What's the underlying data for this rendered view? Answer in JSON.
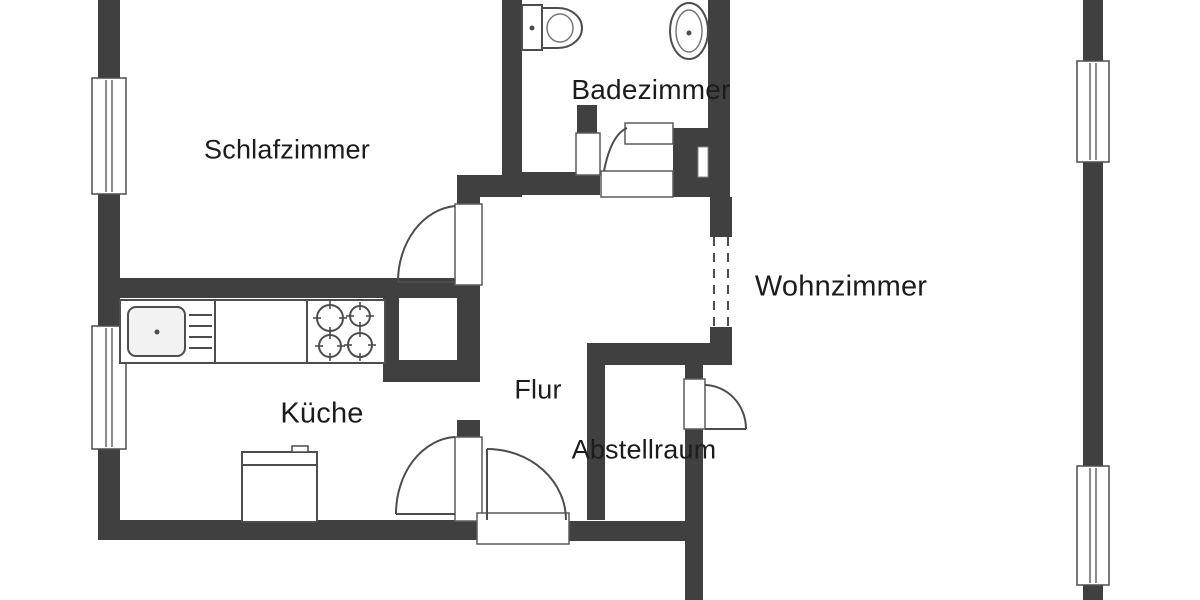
{
  "colors": {
    "wall": "#404040",
    "line": "#4d4d4d",
    "thin": "#777777",
    "label_text": "#1c1c1c",
    "background": "#ffffff",
    "sink_fill": "#f2f2f2"
  },
  "rooms": [
    {
      "id": "schlafzimmer",
      "label": "Schlafzimmer",
      "cx": 287,
      "cy": 150,
      "size": 27
    },
    {
      "id": "badezimmer",
      "label": "Badezimmer",
      "cx": 651,
      "cy": 90,
      "size": 28
    },
    {
      "id": "wohnzimmer",
      "label": "Wohnzimmer",
      "cx": 841,
      "cy": 287,
      "size": 29
    },
    {
      "id": "kueche",
      "label": "Küche",
      "cx": 322,
      "cy": 414,
      "size": 29
    },
    {
      "id": "flur",
      "label": "Flur",
      "cx": 538,
      "cy": 390,
      "size": 27
    },
    {
      "id": "abstellraum",
      "label": "Abstellraum",
      "cx": 644,
      "cy": 450,
      "size": 27
    }
  ],
  "plan": {
    "width": 1200,
    "height": 600,
    "walls": [
      {
        "n": "wall-left-top",
        "x": 98,
        "y": 0,
        "w": 22,
        "h": 80
      },
      {
        "n": "wall-left-mid",
        "x": 98,
        "y": 192,
        "w": 22,
        "h": 136
      },
      {
        "n": "wall-left-bottom",
        "x": 98,
        "y": 447,
        "w": 22,
        "h": 93
      },
      {
        "n": "wall-bottom-left",
        "x": 98,
        "y": 520,
        "w": 382,
        "h": 20
      },
      {
        "n": "wall-bottom-right",
        "x": 567,
        "y": 521,
        "w": 136,
        "h": 20
      },
      {
        "n": "wall-bedroom-bottom",
        "x": 98,
        "y": 278,
        "w": 360,
        "h": 20
      },
      {
        "n": "wall-nook-bottom",
        "x": 457,
        "y": 175,
        "w": 65,
        "h": 22
      },
      {
        "n": "wall-bedroom-bathroom",
        "x": 502,
        "y": 0,
        "w": 20,
        "h": 193
      },
      {
        "n": "wall-flur-left-stub",
        "x": 457,
        "y": 197,
        "w": 23,
        "h": 10
      },
      {
        "n": "wall-flur-left",
        "x": 457,
        "y": 283,
        "w": 23,
        "h": 99
      },
      {
        "n": "wall-niche-left",
        "x": 383,
        "y": 297,
        "w": 16,
        "h": 63
      },
      {
        "n": "wall-niche-bottom",
        "x": 383,
        "y": 360,
        "w": 97,
        "h": 22
      },
      {
        "n": "wall-kitchen-door-stub",
        "x": 457,
        "y": 420,
        "w": 23,
        "h": 18
      },
      {
        "n": "wall-bathroom-bottom",
        "x": 502,
        "y": 172,
        "w": 98,
        "h": 23
      },
      {
        "n": "wall-bathroom-pilaster",
        "x": 577,
        "y": 105,
        "w": 20,
        "h": 28
      },
      {
        "n": "wall-bathroom-corner",
        "x": 673,
        "y": 128,
        "w": 57,
        "h": 69
      },
      {
        "n": "wall-bathroom-right",
        "x": 708,
        "y": 0,
        "w": 22,
        "h": 128
      },
      {
        "n": "wall-flur-wohnzimmer-top",
        "x": 710,
        "y": 197,
        "w": 22,
        "h": 40
      },
      {
        "n": "wall-flur-wohnzimmer-bottom",
        "x": 710,
        "y": 327,
        "w": 22,
        "h": 38
      },
      {
        "n": "wall-storage-top",
        "x": 587,
        "y": 343,
        "w": 145,
        "h": 22
      },
      {
        "n": "wall-storage-left",
        "x": 587,
        "y": 365,
        "w": 18,
        "h": 155
      },
      {
        "n": "wall-storage-right-a",
        "x": 685,
        "y": 365,
        "w": 18,
        "h": 15
      },
      {
        "n": "wall-storage-right-b",
        "x": 685,
        "y": 428,
        "w": 18,
        "h": 12
      },
      {
        "n": "wall-storage-right-c",
        "x": 685,
        "y": 440,
        "w": 18,
        "h": 160
      },
      {
        "n": "wall-right-top",
        "x": 1083,
        "y": 0,
        "w": 20,
        "h": 62
      },
      {
        "n": "wall-right-mid",
        "x": 1083,
        "y": 161,
        "w": 20,
        "h": 306
      },
      {
        "n": "wall-right-bottom",
        "x": 1083,
        "y": 584,
        "w": 20,
        "h": 16
      }
    ],
    "windows": [
      {
        "n": "window-bedroom",
        "x": 92,
        "y": 78,
        "w": 34,
        "h": 116
      },
      {
        "n": "window-kitchen",
        "x": 92,
        "y": 326,
        "w": 34,
        "h": 123
      },
      {
        "n": "window-living-top",
        "x": 1077,
        "y": 61,
        "w": 32,
        "h": 101
      },
      {
        "n": "window-living-bottom",
        "x": 1077,
        "y": 466,
        "w": 32,
        "h": 119
      }
    ],
    "shapes": [
      {
        "t": "rect",
        "n": "bedroom-door-jamb",
        "x": 455,
        "y": 204,
        "w": 27,
        "h": 81,
        "f": "#ffffff",
        "s": "#5a5a5a",
        "sw": 1.5
      },
      {
        "t": "rect",
        "n": "kitchen-door-jamb",
        "x": 455,
        "y": 437,
        "w": 27,
        "h": 84,
        "f": "#ffffff",
        "s": "#5a5a5a",
        "sw": 1.5
      },
      {
        "t": "rect",
        "n": "entrance-door-jamb",
        "x": 477,
        "y": 513,
        "w": 92,
        "h": 31,
        "f": "#ffffff",
        "s": "#5a5a5a",
        "sw": 1.5
      },
      {
        "t": "rect",
        "n": "bathroom-door-jamb",
        "x": 601,
        "y": 171,
        "w": 72,
        "h": 26,
        "f": "#ffffff",
        "s": "#5a5a5a",
        "sw": 1.5
      },
      {
        "t": "rect",
        "n": "bathroom-wall-jamb",
        "x": 576,
        "y": 133,
        "w": 24,
        "h": 42,
        "f": "#ffffff",
        "s": "#5a5a5a",
        "sw": 1.5
      },
      {
        "t": "rect",
        "n": "wall-niche-slot",
        "x": 698,
        "y": 147,
        "w": 10,
        "h": 30,
        "f": "#ffffff",
        "s": "#888888",
        "sw": 1
      },
      {
        "t": "line",
        "n": "bedroom-door-leaf",
        "x1": 398,
        "y1": 282,
        "x2": 455,
        "y2": 282
      },
      {
        "t": "path",
        "n": "bedroom-door-arc",
        "d": "M 398,282 A 62,76 0 0 1 455,206"
      },
      {
        "t": "line",
        "n": "kitchen-door-leaf",
        "x1": 396,
        "y1": 514,
        "x2": 455,
        "y2": 514
      },
      {
        "t": "path",
        "n": "kitchen-door-arc",
        "d": "M 396,514 A 62,77 0 0 1 455,437"
      },
      {
        "t": "line",
        "n": "entrance-door-leaf",
        "x1": 487,
        "y1": 449,
        "x2": 487,
        "y2": 520
      },
      {
        "t": "path",
        "n": "entrance-door-arc",
        "d": "M 487,449 A 79,71 0 0 1 566,520"
      },
      {
        "t": "rect",
        "n": "bathroom-door-leaf",
        "x": 625,
        "y": 123,
        "w": 48,
        "h": 21,
        "f": "#ffffff",
        "s": "#5a5a5a",
        "sw": 1.5
      },
      {
        "t": "path",
        "n": "bathroom-door-arc",
        "d": "M 604,171 Q 611,135 627,128"
      },
      {
        "t": "rect",
        "n": "storage-door-leaf",
        "x": 684,
        "y": 379,
        "w": 21,
        "h": 50,
        "f": "#ffffff",
        "s": "#5a5a5a",
        "sw": 1.5
      },
      {
        "t": "path",
        "n": "storage-door-arc",
        "d": "M 705,385 A 42,44 0 0 1 746,429"
      },
      {
        "t": "line",
        "n": "storage-door-line",
        "x1": 705,
        "y1": 429,
        "x2": 746,
        "y2": 429
      },
      {
        "t": "line",
        "n": "opening-dash-left",
        "x1": 714,
        "y1": 237,
        "x2": 714,
        "y2": 327,
        "dash": "9,7"
      },
      {
        "t": "line",
        "n": "opening-dash-right",
        "x1": 728,
        "y1": 237,
        "x2": 728,
        "y2": 327,
        "dash": "9,7"
      },
      {
        "t": "rect",
        "n": "kitchen-counter",
        "x": 120,
        "y": 300,
        "w": 265,
        "h": 63,
        "f": "#ffffff",
        "s": "#4d4d4d",
        "sw": 2
      },
      {
        "t": "line",
        "n": "counter-divider-1",
        "x1": 215,
        "y1": 300,
        "x2": 215,
        "y2": 363
      },
      {
        "t": "line",
        "n": "counter-divider-2",
        "x1": 307,
        "y1": 300,
        "x2": 307,
        "y2": 363
      },
      {
        "t": "rect",
        "n": "kitchen-sink",
        "x": 128,
        "y": 307,
        "w": 57,
        "h": 49,
        "rx": 8,
        "f": "#f2f2f2",
        "s": "#4d4d4d",
        "sw": 2
      },
      {
        "t": "dot",
        "n": "sink-drain",
        "cx": 157,
        "cy": 332
      },
      {
        "t": "line",
        "n": "drainboard-line",
        "x1": 189,
        "y1": 315,
        "x2": 212,
        "y2": 315
      },
      {
        "t": "line",
        "n": "drainboard-line",
        "x1": 189,
        "y1": 326,
        "x2": 212,
        "y2": 326
      },
      {
        "t": "line",
        "n": "drainboard-line",
        "x1": 189,
        "y1": 337,
        "x2": 212,
        "y2": 337
      },
      {
        "t": "line",
        "n": "drainboard-line",
        "x1": 189,
        "y1": 348,
        "x2": 212,
        "y2": 348
      },
      {
        "t": "burner",
        "n": "stove-burner-1",
        "cx": 330,
        "cy": 318,
        "r": 13
      },
      {
        "t": "burner",
        "n": "stove-burner-2",
        "cx": 360,
        "cy": 316,
        "r": 10
      },
      {
        "t": "burner",
        "n": "stove-burner-3",
        "cx": 330,
        "cy": 346,
        "r": 11
      },
      {
        "t": "burner",
        "n": "stove-burner-4",
        "cx": 360,
        "cy": 345,
        "r": 12
      },
      {
        "t": "rect",
        "n": "fridge",
        "x": 242,
        "y": 452,
        "w": 75,
        "h": 70,
        "f": "#ffffff",
        "s": "#4d4d4d",
        "sw": 2
      },
      {
        "t": "line",
        "n": "fridge-door-line",
        "x1": 242,
        "y1": 465,
        "x2": 317,
        "y2": 465
      },
      {
        "t": "rect",
        "n": "fridge-handle",
        "x": 292,
        "y": 446,
        "w": 16,
        "h": 6,
        "f": "#ffffff",
        "s": "#4d4d4d",
        "sw": 1.5
      },
      {
        "t": "rect",
        "n": "toilet-tank",
        "x": 522,
        "y": 5,
        "w": 20,
        "h": 45,
        "f": "#ffffff",
        "s": "#4d4d4d",
        "sw": 2
      },
      {
        "t": "dot",
        "n": "toilet-dot",
        "cx": 532,
        "cy": 28
      },
      {
        "t": "path",
        "n": "toilet-bowl",
        "d": "M 542,8 h 16 a 24,20 0 0 1 0,40 h -16 z",
        "f": "#ffffff",
        "s": "#4d4d4d",
        "sw": 2
      },
      {
        "t": "ellipse",
        "n": "toilet-bowl-inner",
        "cx": 560,
        "cy": 28,
        "rx": 13,
        "ry": 14,
        "s": "#777777",
        "sw": 1.5
      },
      {
        "t": "ellipse",
        "n": "basin-outer",
        "cx": 689,
        "cy": 31,
        "rx": 19,
        "ry": 28,
        "f": "#ffffff",
        "s": "#4d4d4d",
        "sw": 2
      },
      {
        "t": "ellipse",
        "n": "basin-inner",
        "cx": 689,
        "cy": 31,
        "rx": 13,
        "ry": 21,
        "s": "#777777",
        "sw": 1.5
      },
      {
        "t": "dot",
        "n": "basin-drain",
        "cx": 689,
        "cy": 33
      }
    ]
  }
}
